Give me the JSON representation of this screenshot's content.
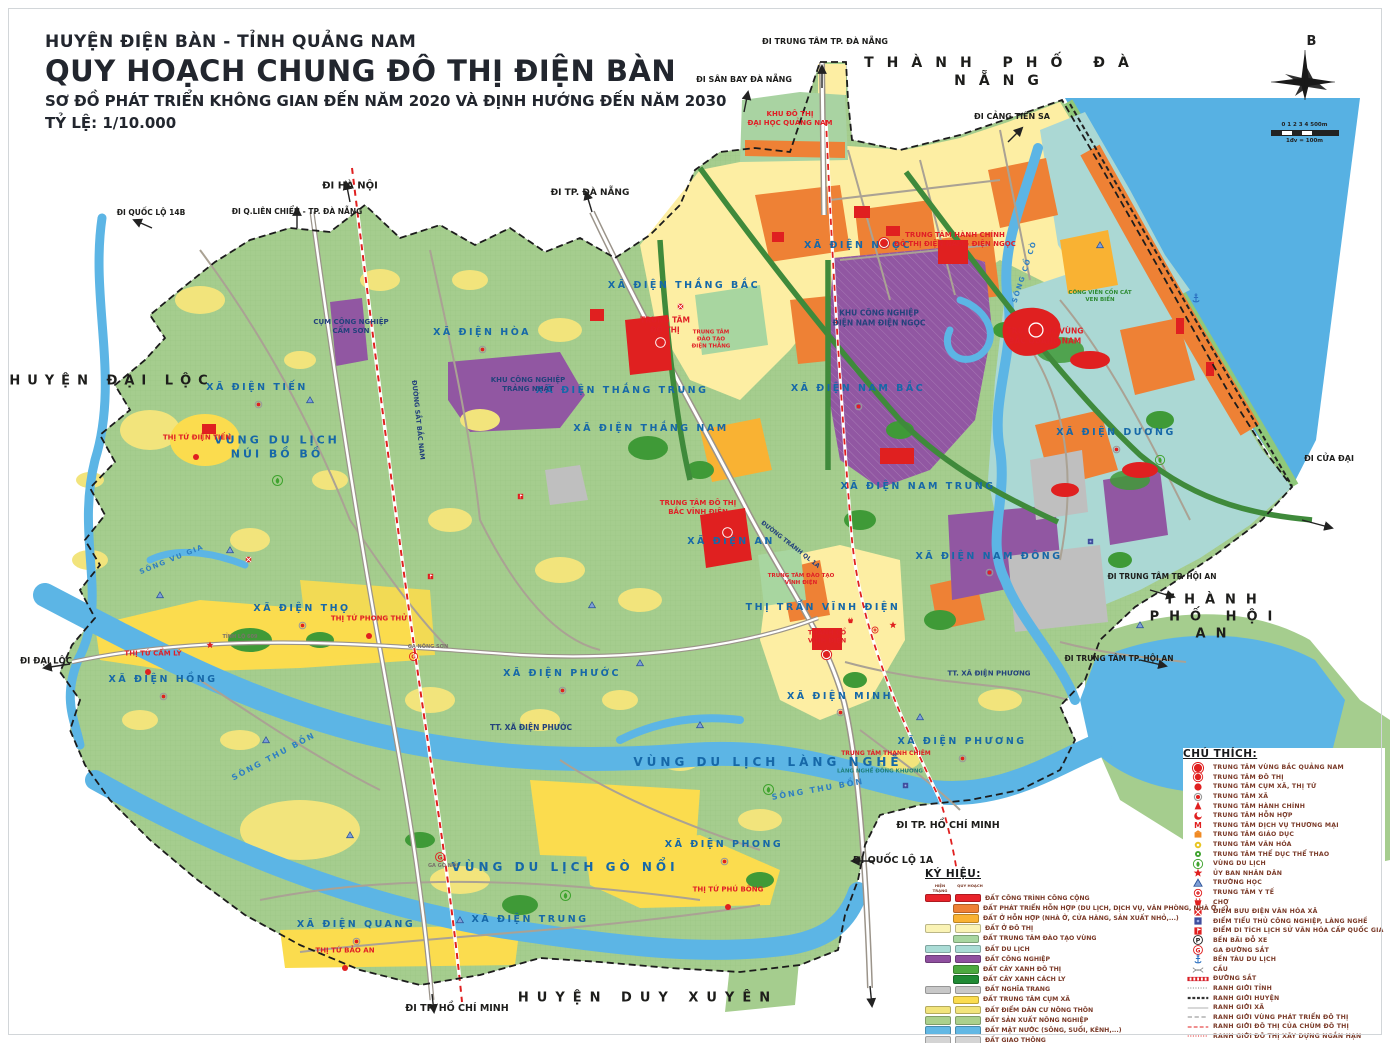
{
  "title_block": {
    "line1": "HUYỆN ĐIỆN BÀN - TỈNH QUẢNG NAM",
    "line2": "QUY HOẠCH CHUNG ĐÔ THỊ ĐIỆN BÀN",
    "line3": "SƠ ĐỒ PHÁT TRIỂN KHÔNG GIAN ĐẾN NĂM 2020 VÀ ĐỊNH HƯỚNG ĐẾN NĂM 2030",
    "line4": "TỶ LỆ: 1/10.000"
  },
  "compass": {
    "north_label": "B",
    "scale_ticks": "0 1 2 3 4",
    "scale_end": "500m",
    "scale_note": "1đv = 100m"
  },
  "colors": {
    "sea": "#57b1e3",
    "land": "#a5cd8e",
    "accent_red": "#e02020",
    "label_blue": "#1668a8"
  },
  "map_labels": [
    {
      "t": "THÀNH PHỐ ĐÀ NẴNG",
      "x": 1003,
      "y": 72,
      "s": 14,
      "c": "black",
      "ls": 13
    },
    {
      "t": "HUYỆN ĐẠI LỘC",
      "x": 112,
      "y": 382,
      "s": 13,
      "c": "black",
      "ls": 7
    },
    {
      "t": "THÀNH PHỐ HỘI AN",
      "x": 1216,
      "y": 618,
      "s": 13,
      "c": "black",
      "ls": 10
    },
    {
      "t": "HUYỆN DUY XUYÊN",
      "x": 648,
      "y": 999,
      "s": 13,
      "c": "black",
      "ls": 8
    },
    {
      "t": "ĐI TRUNG TÂM TP. ĐÀ NẴNG",
      "x": 825,
      "y": 42,
      "s": 8,
      "c": "black"
    },
    {
      "t": "ĐI SÂN BAY ĐÀ NẴNG",
      "x": 744,
      "y": 80,
      "s": 8,
      "c": "black"
    },
    {
      "t": "ĐI CẢNG TIÊN SA",
      "x": 1012,
      "y": 117,
      "s": 8,
      "c": "black"
    },
    {
      "t": "ĐI HÀ NỘI",
      "x": 350,
      "y": 186,
      "s": 10,
      "c": "black"
    },
    {
      "t": "ĐI QUỐC LỘ 14B",
      "x": 151,
      "y": 213,
      "s": 7.5,
      "c": "black"
    },
    {
      "t": "ĐI Q.LIÊN CHIỂU - TP. ĐÀ NẴNG",
      "x": 297,
      "y": 212,
      "s": 7.5,
      "c": "black"
    },
    {
      "t": "ĐI TP. ĐÀ NẴNG",
      "x": 590,
      "y": 194,
      "s": 9,
      "c": "black"
    },
    {
      "t": "ĐI CỬA ĐẠI",
      "x": 1329,
      "y": 459,
      "s": 8,
      "c": "black"
    },
    {
      "t": "ĐI TRUNG TÂM TP. HỘI AN",
      "x": 1162,
      "y": 577,
      "s": 7.5,
      "c": "black"
    },
    {
      "t": "ĐI TRUNG TÂM TP. HỘI AN",
      "x": 1119,
      "y": 659,
      "s": 7.5,
      "c": "black"
    },
    {
      "t": "ĐI ĐẠI LỘC",
      "x": 46,
      "y": 662,
      "s": 8.5,
      "c": "black"
    },
    {
      "t": "ĐI TP. HỒ CHÍ MINH",
      "x": 948,
      "y": 826,
      "s": 9.5,
      "c": "black"
    },
    {
      "t": "ĐI QUỐC LỘ 1A",
      "x": 893,
      "y": 861,
      "s": 9.5,
      "c": "black"
    },
    {
      "t": "ĐI TP. HỒ CHÍ MINH",
      "x": 457,
      "y": 1009,
      "s": 9.5,
      "c": "black"
    },
    {
      "t": "XÃ ĐIỆN NGỌC",
      "x": 858,
      "y": 246,
      "s": 9.5,
      "c": "blue",
      "ls": 2.5
    },
    {
      "t": "XÃ ĐIỆN THẮNG BẮC",
      "x": 684,
      "y": 286,
      "s": 9.5,
      "c": "blue",
      "ls": 2.5
    },
    {
      "t": "XÃ ĐIỆN HÒA",
      "x": 482,
      "y": 333,
      "s": 9.5,
      "c": "blue",
      "ls": 2.5
    },
    {
      "t": "XÃ ĐIỆN TIẾN",
      "x": 257,
      "y": 388,
      "s": 9.5,
      "c": "blue",
      "ls": 2.5
    },
    {
      "t": "XÃ ĐIỆN THẮNG TRUNG",
      "x": 622,
      "y": 391,
      "s": 9.5,
      "c": "blue",
      "ls": 2.5
    },
    {
      "t": "XÃ ĐIỆN THẮNG NAM",
      "x": 651,
      "y": 429,
      "s": 9.5,
      "c": "blue",
      "ls": 2.5
    },
    {
      "t": "XÃ ĐIỆN NAM BẮC",
      "x": 858,
      "y": 389,
      "s": 9.5,
      "c": "blue",
      "ls": 2.5
    },
    {
      "t": "XÃ ĐIỆN NAM TRUNG",
      "x": 918,
      "y": 487,
      "s": 9.5,
      "c": "blue",
      "ls": 2.5
    },
    {
      "t": "XÃ ĐIỆN DƯƠNG",
      "x": 1116,
      "y": 433,
      "s": 9.5,
      "c": "blue",
      "ls": 2.5
    },
    {
      "t": "XÃ ĐIỆN NAM ĐÔNG",
      "x": 989,
      "y": 557,
      "s": 9.5,
      "c": "blue",
      "ls": 2.5
    },
    {
      "t": "XÃ ĐIỆN AN",
      "x": 731,
      "y": 542,
      "s": 9.5,
      "c": "blue",
      "ls": 2.5
    },
    {
      "t": "XÃ ĐIỆN THỌ",
      "x": 302,
      "y": 609,
      "s": 9.5,
      "c": "blue",
      "ls": 2.5
    },
    {
      "t": "XÃ ĐIỆN HỒNG",
      "x": 163,
      "y": 680,
      "s": 9.5,
      "c": "blue",
      "ls": 2.5
    },
    {
      "t": "XÃ ĐIỆN PHƯỚC",
      "x": 562,
      "y": 674,
      "s": 9.5,
      "c": "blue",
      "ls": 2.5
    },
    {
      "t": "XÃ ĐIỆN MINH",
      "x": 840,
      "y": 697,
      "s": 9.5,
      "c": "blue",
      "ls": 2.5
    },
    {
      "t": "XÃ ĐIỆN PHƯƠNG",
      "x": 962,
      "y": 742,
      "s": 9.5,
      "c": "blue",
      "ls": 2.5
    },
    {
      "t": "XÃ ĐIỆN PHONG",
      "x": 724,
      "y": 845,
      "s": 9.5,
      "c": "blue",
      "ls": 2.5
    },
    {
      "t": "XÃ ĐIỆN QUANG",
      "x": 356,
      "y": 925,
      "s": 9.5,
      "c": "blue",
      "ls": 2.5
    },
    {
      "t": "XÃ ĐIỆN TRUNG",
      "x": 530,
      "y": 920,
      "s": 9.5,
      "c": "blue",
      "ls": 2.5
    },
    {
      "t": "TT. XÃ ĐIỆN PHƯỚC",
      "x": 531,
      "y": 728,
      "s": 7.5,
      "c": "navy"
    },
    {
      "t": "TT. XÃ ĐIỆN PHƯƠNG",
      "x": 989,
      "y": 674,
      "s": 7,
      "c": "navy"
    },
    {
      "t": "THỊ TRẤN VĨNH ĐIỆN",
      "x": 823,
      "y": 608,
      "s": 9.5,
      "c": "blue",
      "ls": 2.5
    },
    {
      "t": "VÙNG DU LỊCH\nNÚI BỒ BỒ",
      "x": 277,
      "y": 448,
      "s": 11,
      "c": "blue",
      "ls": 3
    },
    {
      "t": "VÙNG DU LỊCH LÀNG NGHỀ",
      "x": 768,
      "y": 763,
      "s": 12,
      "c": "blue",
      "ls": 4
    },
    {
      "t": "VÙNG DU LỊCH GÒ NỔI",
      "x": 565,
      "y": 868,
      "s": 12,
      "c": "blue",
      "ls": 4
    },
    {
      "t": "KHU ĐÔ THỊ\nĐẠI HỌC QUẢNG NAM",
      "x": 790,
      "y": 119,
      "s": 7,
      "c": "red"
    },
    {
      "t": "CỤM CÔNG NGHIỆP\nCẨM SƠN",
      "x": 351,
      "y": 327,
      "s": 7,
      "c": "navy"
    },
    {
      "t": "KHU CÔNG NGHIỆP\nTRẢNG NHẬT",
      "x": 528,
      "y": 385,
      "s": 7,
      "c": "navy"
    },
    {
      "t": "TRUNG TÂM\nĐÔ THỊ",
      "x": 665,
      "y": 325,
      "s": 7.5,
      "c": "red"
    },
    {
      "t": "TRUNG TÂM\nĐÀO TẠO\nĐIỆN THẮNG",
      "x": 711,
      "y": 340,
      "s": 5.5,
      "c": "red"
    },
    {
      "t": "KHU CÔNG NGHIỆP\nĐIỆN NAM ĐIỆN NGỌC",
      "x": 879,
      "y": 318,
      "s": 7.5,
      "c": "navy"
    },
    {
      "t": "TRUNG TÂM HÀNH CHÍNH\nĐÔ THỊ ĐIỆN NAM - ĐIỆN NGỌC",
      "x": 955,
      "y": 240,
      "s": 7,
      "c": "red"
    },
    {
      "t": "TRUNG TÂM VÙNG\nBẮC QUẢNG NAM",
      "x": 1045,
      "y": 336,
      "s": 7.5,
      "c": "red"
    },
    {
      "t": "CÔNG VIÊN CỒN CÁT\nVEN BIỂN",
      "x": 1100,
      "y": 297,
      "s": 5.5,
      "c": "green"
    },
    {
      "t": "THỊ TỨ ĐIỆN TIẾN",
      "x": 197,
      "y": 438,
      "s": 7,
      "c": "red"
    },
    {
      "t": "TRUNG TÂM ĐÔ THỊ\nBẮC VĨNH ĐIỆN",
      "x": 698,
      "y": 508,
      "s": 7,
      "c": "red"
    },
    {
      "t": "TRUNG TÂM ĐÀO TẠO\nVĨNH ĐIỆN",
      "x": 801,
      "y": 580,
      "s": 5.5,
      "c": "red"
    },
    {
      "t": "THÀNH CỔ\nVĨNH ĐIỆN",
      "x": 827,
      "y": 637,
      "s": 6.5,
      "c": "red"
    },
    {
      "t": "TRUNG TÂM THANH CHIÊM",
      "x": 886,
      "y": 754,
      "s": 6,
      "c": "red"
    },
    {
      "t": "LÀNG NGHỀ ĐÔNG KHƯƠNG",
      "x": 880,
      "y": 772,
      "s": 5.5,
      "c": "teal"
    },
    {
      "t": "THỊ TỨ PHONG THỬ",
      "x": 369,
      "y": 619,
      "s": 7,
      "c": "red"
    },
    {
      "t": "THỊ TỨ CẨM LÝ",
      "x": 153,
      "y": 654,
      "s": 7,
      "c": "red"
    },
    {
      "t": "THỊ TỨ PHÚ BÔNG",
      "x": 728,
      "y": 890,
      "s": 7,
      "c": "red"
    },
    {
      "t": "THỊ TỨ BẢO AN",
      "x": 345,
      "y": 951,
      "s": 7,
      "c": "red"
    },
    {
      "t": "SÔNG THU BỒN",
      "x": 274,
      "y": 757,
      "s": 8,
      "c": "water",
      "r": -28,
      "ls": 2
    },
    {
      "t": "SÔNG THU BỒN",
      "x": 818,
      "y": 790,
      "s": 8,
      "c": "water",
      "r": -10,
      "ls": 2
    },
    {
      "t": "SÔNG CỔ CÒ",
      "x": 1025,
      "y": 272,
      "s": 7,
      "c": "water",
      "r": -72,
      "ls": 1.5
    },
    {
      "t": "SÔNG VU GIA",
      "x": 172,
      "y": 560,
      "s": 7,
      "c": "water",
      "r": -22,
      "ls": 1.5
    },
    {
      "t": "ĐƯỜNG SẮT BẮC NAM",
      "x": 418,
      "y": 420,
      "s": 6.5,
      "c": "navy",
      "r": 84
    },
    {
      "t": "ĐƯỜNG TRÁNH QL 1A",
      "x": 790,
      "y": 545,
      "s": 6,
      "c": "navy",
      "r": 38
    },
    {
      "t": "GA NÔNG SƠN",
      "x": 428,
      "y": 647,
      "s": 5,
      "c": "gray"
    },
    {
      "t": "GA GÒ NỔI",
      "x": 443,
      "y": 866,
      "s": 5,
      "c": "gray"
    },
    {
      "t": "TỈNH LỘ 609",
      "x": 240,
      "y": 637,
      "s": 5,
      "c": "gray"
    }
  ],
  "map_markers": [
    {
      "i": "region-center-icon",
      "x": 1036,
      "y": 330,
      "z": 18
    },
    {
      "i": "urban-center-icon",
      "x": 660,
      "y": 342,
      "z": 15
    },
    {
      "i": "urban-center-icon",
      "x": 727,
      "y": 532,
      "z": 15
    },
    {
      "i": "urban-center-icon",
      "x": 884,
      "y": 242,
      "z": 14
    },
    {
      "i": "urban-center-icon",
      "x": 826,
      "y": 652,
      "z": 13
    },
    {
      "i": "commune-center-icon",
      "x": 482,
      "y": 345,
      "z": 11
    },
    {
      "i": "commune-center-icon",
      "x": 258,
      "y": 400,
      "z": 11
    },
    {
      "i": "commune-center-icon",
      "x": 302,
      "y": 621,
      "z": 11
    },
    {
      "i": "commune-center-icon",
      "x": 163,
      "y": 692,
      "z": 11
    },
    {
      "i": "commune-center-icon",
      "x": 562,
      "y": 686,
      "z": 11
    },
    {
      "i": "commune-center-icon",
      "x": 840,
      "y": 708,
      "z": 11
    },
    {
      "i": "commune-center-icon",
      "x": 962,
      "y": 754,
      "z": 11
    },
    {
      "i": "commune-center-icon",
      "x": 724,
      "y": 857,
      "z": 11
    },
    {
      "i": "commune-center-icon",
      "x": 356,
      "y": 937,
      "z": 11
    },
    {
      "i": "commune-center-icon",
      "x": 1120,
      "y": 944,
      "z": 11
    },
    {
      "i": "commune-center-icon",
      "x": 1116,
      "y": 445,
      "z": 11
    },
    {
      "i": "commune-center-icon",
      "x": 989,
      "y": 568,
      "z": 11
    },
    {
      "i": "commune-center-icon",
      "x": 858,
      "y": 402,
      "z": 11
    },
    {
      "i": "commune-cluster-center-icon",
      "x": 196,
      "y": 452,
      "z": 10
    },
    {
      "i": "commune-cluster-center-icon",
      "x": 148,
      "y": 667,
      "z": 10
    },
    {
      "i": "commune-cluster-center-icon",
      "x": 369,
      "y": 631,
      "z": 10
    },
    {
      "i": "commune-cluster-center-icon",
      "x": 728,
      "y": 902,
      "z": 10
    },
    {
      "i": "commune-cluster-center-icon",
      "x": 345,
      "y": 963,
      "z": 10
    },
    {
      "i": "school-icon",
      "x": 310,
      "y": 395,
      "z": 10
    },
    {
      "i": "school-icon",
      "x": 230,
      "y": 545,
      "z": 10
    },
    {
      "i": "school-icon",
      "x": 266,
      "y": 735,
      "z": 10
    },
    {
      "i": "school-icon",
      "x": 350,
      "y": 830,
      "z": 10
    },
    {
      "i": "school-icon",
      "x": 460,
      "y": 915,
      "z": 10
    },
    {
      "i": "school-icon",
      "x": 592,
      "y": 600,
      "z": 10
    },
    {
      "i": "school-icon",
      "x": 640,
      "y": 658,
      "z": 10
    },
    {
      "i": "school-icon",
      "x": 700,
      "y": 720,
      "z": 10
    },
    {
      "i": "school-icon",
      "x": 920,
      "y": 712,
      "z": 10
    },
    {
      "i": "school-icon",
      "x": 1140,
      "y": 620,
      "z": 10
    },
    {
      "i": "school-icon",
      "x": 160,
      "y": 590,
      "z": 10
    },
    {
      "i": "school-icon",
      "x": 1100,
      "y": 240,
      "z": 10
    },
    {
      "i": "people-committee-icon",
      "x": 210,
      "y": 640,
      "z": 10
    },
    {
      "i": "people-committee-icon",
      "x": 893,
      "y": 620,
      "z": 10
    },
    {
      "i": "railway-station-icon",
      "x": 440,
      "y": 854,
      "z": 12
    },
    {
      "i": "railway-station-icon",
      "x": 413,
      "y": 652,
      "z": 11
    },
    {
      "i": "tourism-zone-icon",
      "x": 277,
      "y": 478,
      "z": 13
    },
    {
      "i": "tourism-zone-icon",
      "x": 768,
      "y": 787,
      "z": 13
    },
    {
      "i": "tourism-zone-icon",
      "x": 565,
      "y": 893,
      "z": 13
    },
    {
      "i": "tourism-zone-icon",
      "x": 1160,
      "y": 457,
      "z": 12
    },
    {
      "i": "tourist-wharf-icon",
      "x": 1196,
      "y": 296,
      "z": 12
    },
    {
      "i": "post-office-icon",
      "x": 248,
      "y": 553,
      "z": 9
    },
    {
      "i": "post-office-icon",
      "x": 680,
      "y": 300,
      "z": 9
    },
    {
      "i": "heritage-icon",
      "x": 520,
      "y": 490,
      "z": 9
    },
    {
      "i": "heritage-icon",
      "x": 430,
      "y": 570,
      "z": 9
    },
    {
      "i": "craft-village-icon",
      "x": 905,
      "y": 779,
      "z": 9
    },
    {
      "i": "craft-village-icon",
      "x": 1090,
      "y": 535,
      "z": 9
    },
    {
      "i": "medical-center-icon",
      "x": 875,
      "y": 625,
      "z": 10
    },
    {
      "i": "market-icon",
      "x": 850,
      "y": 614,
      "z": 9
    }
  ],
  "chu_thich": {
    "title": "CHÚ THÍCH:",
    "items": [
      {
        "icon": "region-center-icon",
        "label": "TRUNG TÂM VÙNG BẮC QUẢNG NAM"
      },
      {
        "icon": "urban-center-icon",
        "label": "TRUNG TÂM ĐÔ THỊ"
      },
      {
        "icon": "commune-cluster-center-icon",
        "label": "TRUNG TÂM CỤM XÃ, THỊ TỨ"
      },
      {
        "icon": "commune-center-icon",
        "label": "TRUNG TÂM XÃ"
      },
      {
        "icon": "admin-center-icon",
        "label": "TRUNG TÂM HÀNH CHÍNH"
      },
      {
        "icon": "mixed-center-icon",
        "label": "TRUNG TÂM HỖN HỢP"
      },
      {
        "icon": "trade-service-center-icon",
        "label": "TRUNG TÂM DỊCH VỤ THƯƠNG MẠI"
      },
      {
        "icon": "education-center-icon",
        "label": "TRUNG TÂM GIÁO DỤC"
      },
      {
        "icon": "culture-center-icon",
        "label": "TRUNG TÂM VĂN HÓA"
      },
      {
        "icon": "sports-center-icon",
        "label": "TRUNG TÂM THỂ DỤC THỂ THAO"
      },
      {
        "icon": "tourism-zone-icon",
        "label": "VÙNG DU LỊCH"
      },
      {
        "icon": "people-committee-icon",
        "label": "ỦY BAN NHÂN DÂN"
      },
      {
        "icon": "school-icon",
        "label": "TRƯỜNG HỌC"
      },
      {
        "icon": "medical-center-icon",
        "label": "TRUNG TÂM Y TẾ"
      },
      {
        "icon": "market-icon",
        "label": "CHỢ"
      },
      {
        "icon": "post-office-icon",
        "label": "ĐIỂM BƯU ĐIỆN VĂN HÓA XÃ"
      },
      {
        "icon": "craft-village-icon",
        "label": "ĐIỂM TIỂU THỦ CÔNG NGHIỆP, LÀNG NGHỀ"
      },
      {
        "icon": "heritage-icon",
        "label": "ĐIỂM DI TÍCH LỊCH SỬ VĂN HÓA CẤP QUỐC GIA"
      },
      {
        "icon": "parking-icon",
        "label": "BẾN BÃI ĐỖ XE"
      },
      {
        "icon": "railway-station-icon",
        "label": "GA ĐƯỜNG SẮT"
      },
      {
        "icon": "tourist-wharf-icon",
        "label": "BẾN TÀU DU LỊCH"
      },
      {
        "icon": "bridge-icon",
        "label": "CẦU"
      },
      {
        "icon": "railway-line",
        "label": "ĐƯỜNG SẮT"
      },
      {
        "icon": "province-boundary-line",
        "label": "RANH GIỚI TỈNH"
      },
      {
        "icon": "district-boundary-line",
        "label": "RANH GIỚI HUYỆN"
      },
      {
        "icon": "commune-boundary-line",
        "label": "RANH GIỚI XÃ"
      },
      {
        "icon": "urban-dev-boundary-line",
        "label": "RANH GIỚI VÙNG PHÁT TRIỂN ĐÔ THỊ"
      },
      {
        "icon": "urban-cluster-boundary-line",
        "label": "RANH GIỚI ĐÔ THỊ CỦA CHÙM ĐÔ THỊ"
      },
      {
        "icon": "shortterm-urban-boundary-line",
        "label": "RANH GIỚI ĐÔ THỊ XÂY DỰNG NGẮN HẠN"
      }
    ]
  },
  "ky_hieu": {
    "title": "KÝ HIỆU:",
    "col_existing": "HIỆN TRẠNG",
    "col_planned": "QUY HOẠCH",
    "items": [
      {
        "existing": true,
        "color": "#e8232a",
        "label": "ĐẤT CÔNG TRÌNH CÔNG CỘNG"
      },
      {
        "existing": false,
        "color": "#ee8135",
        "label": "ĐẤT PHÁT TRIỂN HỖN HỢP (DU LỊCH, DỊCH VỤ, VĂN PHÒNG, NHÀ Ở,...)"
      },
      {
        "existing": false,
        "color": "#f9b233",
        "label": "ĐẤT Ở HỖN HỢP (NHÀ Ở, CỬA HÀNG, SẢN XUẤT NHỎ,...)"
      },
      {
        "existing": true,
        "color": "#faf3b5",
        "label": "ĐẤT Ở ĐÔ THỊ"
      },
      {
        "existing": false,
        "color": "#a8d6a0",
        "label": "ĐẤT TRUNG TÂM ĐÀO TẠO VÙNG"
      },
      {
        "existing": true,
        "color": "#aadcd6",
        "label": "ĐẤT DU LỊCH"
      },
      {
        "existing": true,
        "color": "#8f4f9f",
        "label": "ĐẤT CÔNG NGHIỆP"
      },
      {
        "existing": false,
        "color": "#4ca93f",
        "label": "ĐẤT CÂY XANH ĐÔ THỊ"
      },
      {
        "existing": false,
        "color": "#1f8a34",
        "label": "ĐẤT CÂY XANH CÁCH LY"
      },
      {
        "existing": true,
        "color": "#c8c8c8",
        "label": "ĐẤT NGHĨA TRANG"
      },
      {
        "existing": false,
        "color": "#fbdc4e",
        "label": "ĐẤT TRUNG TÂM CỤM XÃ"
      },
      {
        "existing": true,
        "color": "#f2e47c",
        "label": "ĐẤT ĐIỂM DÂN CƯ NÔNG THÔN"
      },
      {
        "existing": true,
        "color": "#abd08c",
        "label": "ĐẤT SẢN XUẤT NÔNG NGHIỆP"
      },
      {
        "existing": true,
        "color": "#62b8e4",
        "label": "ĐẤT MẶT NƯỚC (SÔNG, SUỐI, KÊNH,...)"
      },
      {
        "existing": true,
        "color": "#d4d4d4",
        "label": "ĐẤT GIAO THÔNG"
      }
    ]
  }
}
